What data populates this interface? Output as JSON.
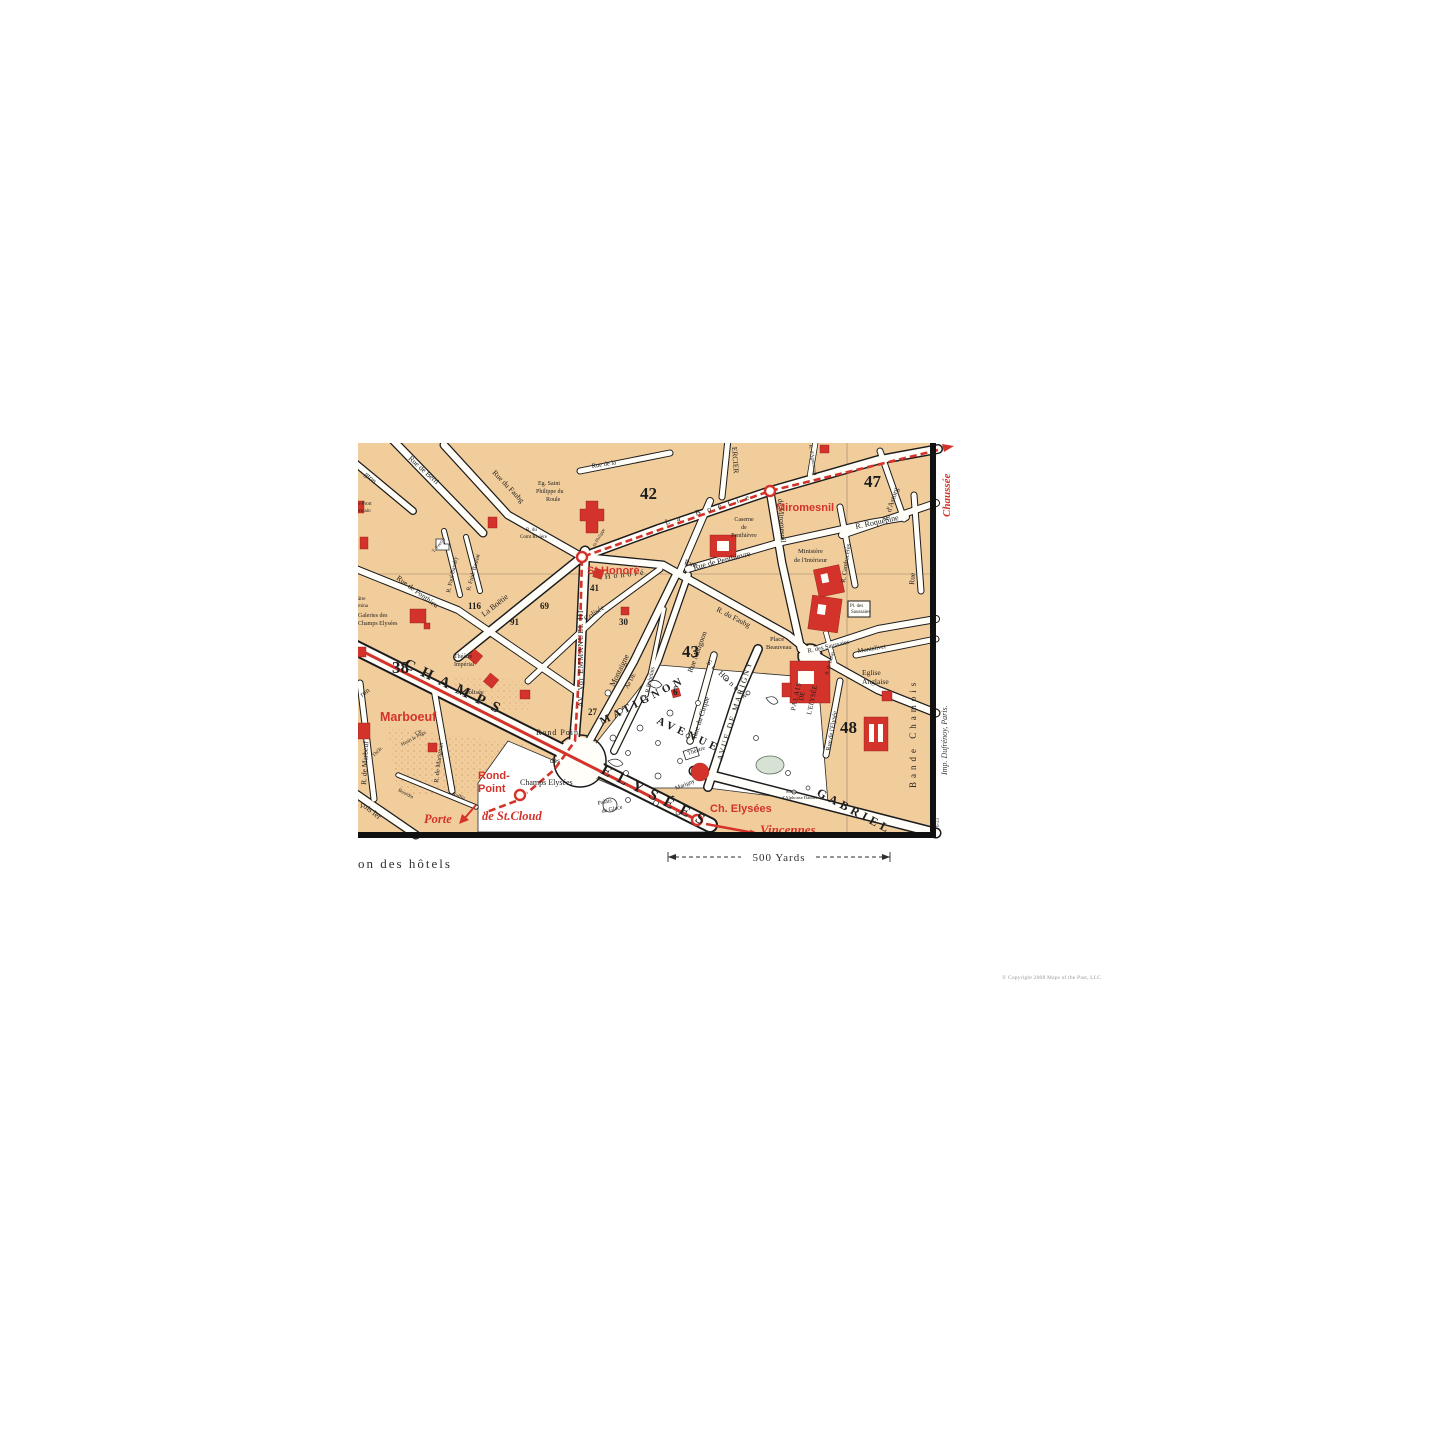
{
  "page": {
    "copyright": "© Copyright 2008 Maps of the Past, LLC"
  },
  "map_meta": {
    "region": "Paris - Champs Elysées district",
    "colors": {
      "block_tan": "#f2cd9c",
      "street_white": "#fffef9",
      "accent_red": "#d3332a",
      "ink_black": "#1d1d1d"
    }
  },
  "t": {
    "champs": "CHAMPS",
    "elysees": "ELYSÉES",
    "avenue": "AVENUE",
    "matignon_big": "MATIGNON",
    "gabriel": "GABRIEL",
    "n38": "38",
    "n42": "42",
    "n43": "43",
    "n47": "47",
    "n48": "48",
    "n41": "41",
    "n30": "30",
    "n6": "6",
    "n27": "27",
    "n69": "69",
    "n91": "91",
    "n116": "116",
    "washington_frag": "gton",
    "rue_de_berri": "Rue de Berri",
    "rue_du_faubg_w": "Rue du Faubg",
    "rue_frag": "Rue",
    "honore_sp": "Honoré",
    "faubg_e": "R. du Faubg",
    "st_honore_sp": "St Honoré",
    "la_boetie_w": "La Boëtie",
    "la_boetie_e": "La Boëtie",
    "rue_de_la": "Rue de la",
    "mercier": "ERCIER",
    "aguesseau": "R. d'Aguesseau",
    "ponthieu": "Rue de Ponthieu",
    "colisee_rue": "Colisée",
    "le_colisee": "le Colisée",
    "theatre_imp_1": "Théâtre",
    "theatre_imp_2": "Impérial",
    "av_emmanuel": "AV. Vor EMMANUEL III",
    "miromesnil_rue": "de Miromesnil",
    "penthievre_rue": "Rue de Penthievre",
    "caserne_1": "Caserne",
    "caserne_2": "de",
    "caserne_3": "Penthièvre",
    "roquepine": "R. Roquépine",
    "astorg": "R. d'Astorg",
    "cambaceres": "R. Cambacérès",
    "rue_v": "Rue",
    "bande_chamois": "Bande Chamois",
    "ministere_1": "Ministère",
    "ministere_2": "de l'Intérieur",
    "pl_saussaies_1": "Pl. des",
    "pl_saussaies_2": "Saussaies",
    "r_saussaies": "R. des Saussaies",
    "duras": "R. de Duras",
    "montalivet": "Montalivet",
    "eglise_1": "Eglise",
    "eglise_2": "Anglaise",
    "beauveau_1": "Place",
    "beauveau_2": "Beauveau",
    "cirque": "Rue du Cirque",
    "av_marigny": "AVUE DE MARIGNY",
    "rue_matignon": "Rue Matignon",
    "montaigne": "Montaigne",
    "ae_de": "Ae DE",
    "rabelais": "R.Rabelais",
    "palais_1": "PALAIS",
    "palais_2": "DE",
    "palais_3": "L'ELYSÉE",
    "rue_elysee": "Rue de l'Elysée",
    "statue_1": "Statue",
    "statue_2": "d'Alphonse Daudet",
    "th_marigny_1": "Théâtre",
    "th_marigny_2": "Marigny",
    "glace_1": "Palais",
    "glace_2": "de Glace",
    "rond_point_pl": "Rond Point",
    "des": "des",
    "champs_pl": "Champs Elysées",
    "page_1": "Cie",
    "page_2": "Henri le Page",
    "marignan": "R. de Marignan",
    "bourdin": "Bourdin",
    "ruffin": "Ruffin",
    "francois_frag": "çois Ier",
    "ron_frag": "ron",
    "marbeuf_st": "R. de Marbeuf",
    "femina_1": "âtre",
    "femina_2": "mina",
    "galeries_1": "Galeries des",
    "galeries_2": "Champs Elysées",
    "prot_1": "le Prott",
    "prot_2": "éricain",
    "fortin": "T. Fortin",
    "baudry": "R. Paul Baudry",
    "bastiat": "R. Fréd. Bastiat",
    "riviere_1": "R. du",
    "riviere_2": "Comt Rivière",
    "st_philippe_sm": "St Philippe",
    "eg_roule_1": "Eg. Saint",
    "eg_roule_2": "Philippe du",
    "eg_roule_3": "Roule",
    "theat_sm": "Théât.",
    "m_st_honore": "St.Honoré",
    "m_miromesnil": "Miromesnil",
    "m_marboeuf": "Marboeuf",
    "m_rond_1": "Rond-",
    "m_rond_2": "Point",
    "m_ch_elysees": "Ch. Elysées",
    "m_porte": "Porte",
    "m_st_cloud": "de St.Cloud",
    "m_vincennes": "Vincennes",
    "m_chaussee": "Chaussée",
    "imp": "Imp. Dufrénoy, Paris.",
    "plate": "6-23",
    "hotels": "on des hôtels",
    "yards": "500 Yards"
  }
}
